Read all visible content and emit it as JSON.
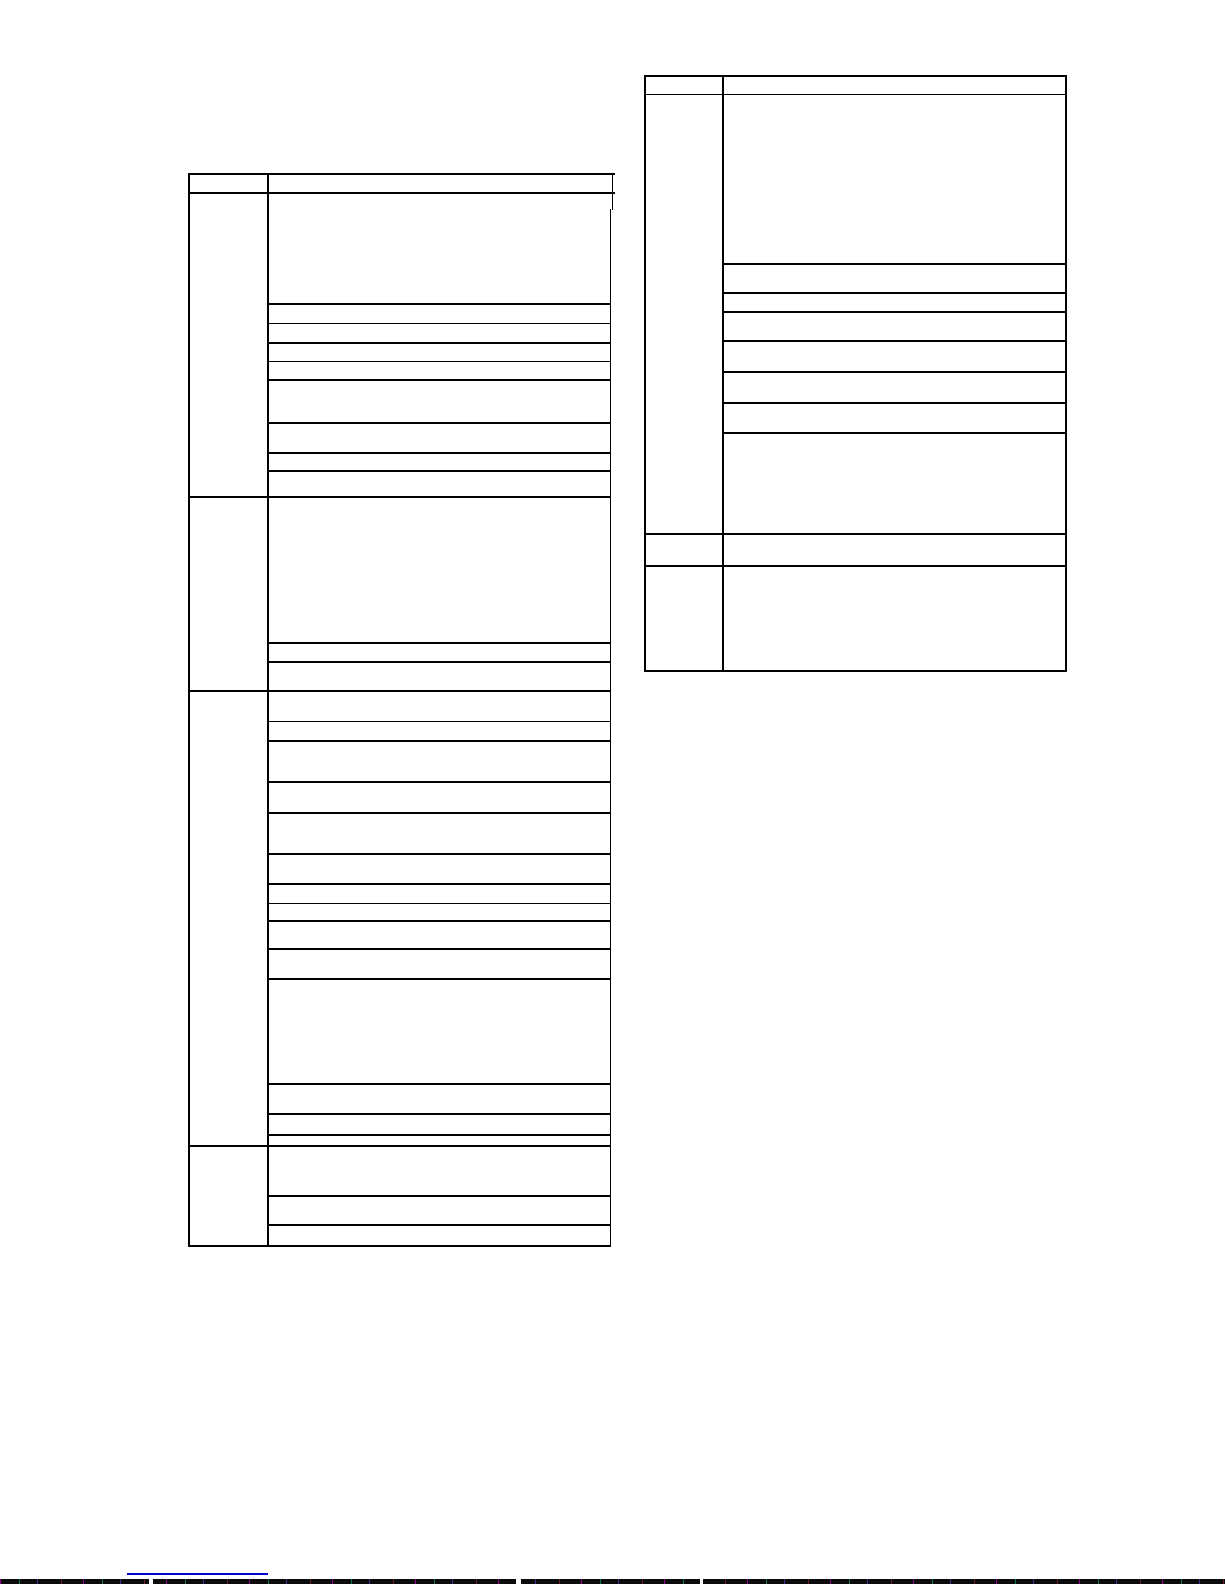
{
  "page": {
    "width": 1225,
    "height": 1585,
    "background_color": "#ffffff",
    "line_color": "#000000",
    "line_thickness": 1.5,
    "visible_text": ""
  },
  "tables": [
    {
      "name": "left-table",
      "description": "empty ruled table, two columns, header row and four row-groups, no text rendered",
      "x": 188,
      "right": 609.5,
      "col_divider": 267,
      "top": 173,
      "header_bottom": 192,
      "bottom": 1245,
      "header_right_extend": 613,
      "right_border_from": 209,
      "extra_lines": [
        {
          "x": 611.5,
          "y": 173,
          "h": 37
        }
      ],
      "group_boundaries": [
        496,
        690,
        1145
      ],
      "row_dividers": [
        [
          303,
          322.5,
          342,
          360.5,
          379,
          422,
          452,
          470
        ],
        [
          642,
          661
        ],
        [
          720.5,
          740,
          781,
          812,
          853,
          883,
          902.5,
          920,
          948,
          978,
          1083,
          1113,
          1134
        ],
        [
          1195,
          1224
        ]
      ]
    },
    {
      "name": "right-table",
      "description": "empty ruled table, two columns, header row and three row-groups, no text rendered",
      "x": 644,
      "right": 1065,
      "col_divider": 722,
      "top": 75,
      "header_bottom": 93.5,
      "bottom": 670,
      "group_boundaries": [
        533,
        565
      ],
      "row_dividers": [
        [
          263,
          292,
          311,
          340,
          371,
          402,
          432
        ],
        [],
        []
      ]
    }
  ],
  "link_underline": {
    "x": 127,
    "y": 1573,
    "width": 141,
    "height": 2,
    "color": "#0000d0",
    "text": ""
  },
  "bottom_strip": {
    "x": 0,
    "y": 1579,
    "width": 1225,
    "height": 5,
    "base_color": "#0b0b0b",
    "gaps": [
      {
        "x": 149,
        "w": 4
      },
      {
        "x": 516,
        "w": 5
      },
      {
        "x": 700,
        "w": 3
      }
    ]
  }
}
